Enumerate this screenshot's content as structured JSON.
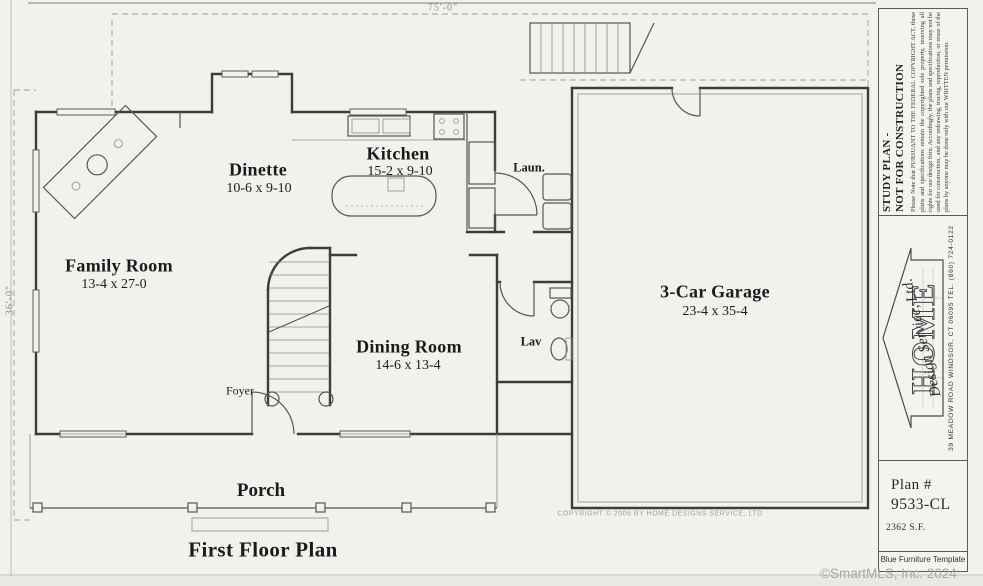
{
  "plan": {
    "title": "First Floor Plan",
    "copyright": "COPYRIGHT © 2006 BY HOME DESIGNS SERVICE, LTD",
    "dimensions": {
      "width": "75'-0\"",
      "height": "36'-0\""
    },
    "rooms": {
      "family_room": {
        "name": "Family Room",
        "size": "13-4 x 27-0"
      },
      "dinette": {
        "name": "Dinette",
        "size": "10-6 x 9-10"
      },
      "kitchen": {
        "name": "Kitchen",
        "size": "15-2 x 9-10"
      },
      "laundry": {
        "name": "Laun."
      },
      "dining_room": {
        "name": "Dining Room",
        "size": "14-6 x 13-4"
      },
      "lav": {
        "name": "Lav"
      },
      "foyer": {
        "name": "Foyer"
      },
      "garage": {
        "name": "3-Car Garage",
        "size": "23-4 x 35-4"
      },
      "porch": {
        "name": "Porch"
      }
    }
  },
  "title_block": {
    "study_plan": {
      "heading_line1": "STUDY PLAN -",
      "heading_line2": "NOT FOR CONSTRUCTION",
      "disclaimer": "Please Note that PURSUANT TO THE FEDERAL COPYRIGHT ACT, these plans and specifications remain the copyrighted sole property, reserving all rights for our design firm. Accordingly, the plans and specifications may not be used for construction, and any redrawing, tracing, reproduction, or reuse of the plans by anyone may be done only with our WRITTEN permission."
    },
    "firm": {
      "logo_word": "HOME",
      "logo_script": "Design Service, Ltd.",
      "address": "39 MEADOW ROAD    WINDSOR, CT 06095    TEL. (860) 724-0122"
    },
    "plan_number": {
      "label": "Plan #",
      "value": "9533-CL",
      "area": "2362 S.F."
    },
    "template_note": "Blue Furniture Template"
  },
  "page": {
    "watermark": "©SmartMLS, Inc. 2024"
  },
  "colors": {
    "paper": "#f2f1ee",
    "ink": "#3c3c3c",
    "faint": "#9e9e9e",
    "watermark": "#a8a8a8"
  }
}
